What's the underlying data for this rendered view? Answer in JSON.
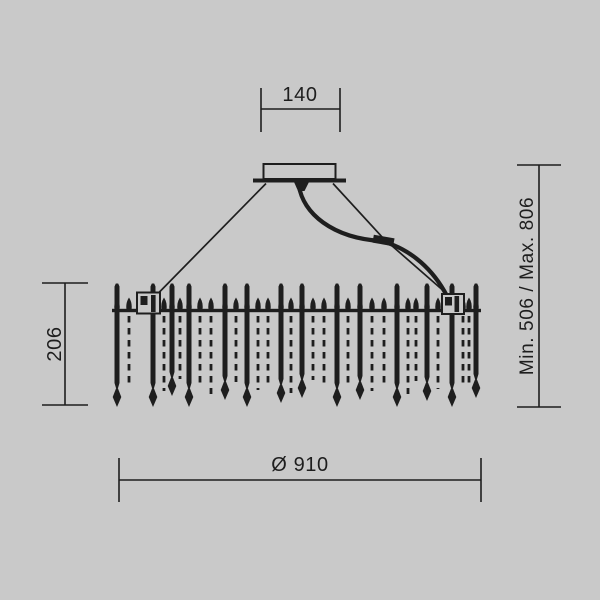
{
  "background_color": "#c9c9c9",
  "line_color": "#1e1e1e",
  "diagram": {
    "type": "technical-dimension-drawing",
    "subject": "chandelier",
    "dimension_labels": {
      "canopy_width": "140",
      "body_height": "206",
      "suspension_height": "Min. 506 / Max. 806",
      "diameter": "Ø 910"
    },
    "fixture_geometry": {
      "bar": {
        "x1": 112,
        "x2": 481,
        "y": 310.5,
        "thickness": 3.4
      },
      "rods": {
        "xs": [
          117,
          153,
          172,
          189,
          225,
          247,
          281,
          302,
          337,
          360,
          397,
          427,
          452,
          476
        ],
        "tip_ys": [
          407,
          407,
          396,
          407,
          400,
          407,
          403,
          398,
          407,
          400,
          407,
          401,
          407,
          398
        ],
        "top_y": 283.5,
        "width": 5
      },
      "strands": {
        "xs": [
          129,
          164,
          180,
          200,
          211,
          236,
          258,
          268,
          291,
          313,
          324,
          348,
          372,
          384,
          408,
          416,
          438,
          463,
          469
        ],
        "bottom_ys": [
          385,
          391,
          379,
          388,
          394,
          382,
          390,
          385,
          393,
          380,
          388,
          383,
          391,
          386,
          394,
          381,
          389,
          384,
          387
        ],
        "top_y": 316,
        "width": 2.8,
        "dash": "6.5 5.5"
      }
    }
  }
}
